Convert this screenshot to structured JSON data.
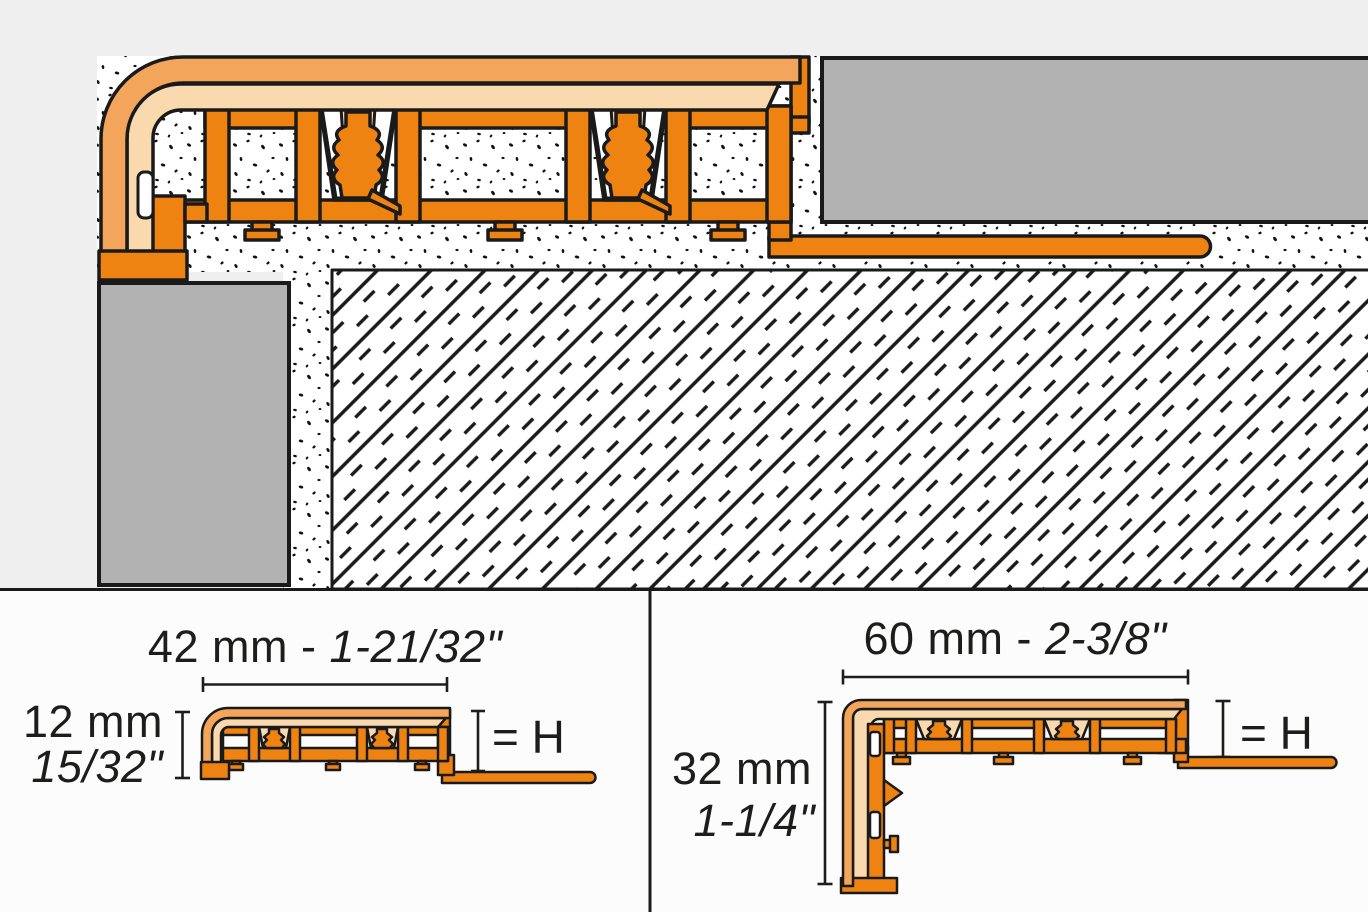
{
  "diagram": {
    "type": "profile-cross-section-technical-drawing",
    "top_view": {
      "description": "installation cross-section of stair-nosing movement profile with tread tile, riser tile, thinset mortar and substrate"
    },
    "left_panel": {
      "width_metric": "42 mm - ",
      "width_imperial": "1-21/32\"",
      "height_metric": "12 mm",
      "height_imperial": "15/32\"",
      "h_label": "= H"
    },
    "right_panel": {
      "width_metric": "60 mm - ",
      "width_imperial": "2-3/8\"",
      "height_metric": "32 mm",
      "height_imperial": "1-1/4\"",
      "h_label": "= H"
    },
    "colors": {
      "profile_dark_orange": "#ee8312",
      "profile_mid_orange": "#f3a55c",
      "profile_light_peach": "#fbd9af",
      "tile_gray": "#b2b2b2",
      "background_gray": "#efefef",
      "panel_background": "#fcfcfc",
      "line_black": "#1a1a1a"
    }
  }
}
